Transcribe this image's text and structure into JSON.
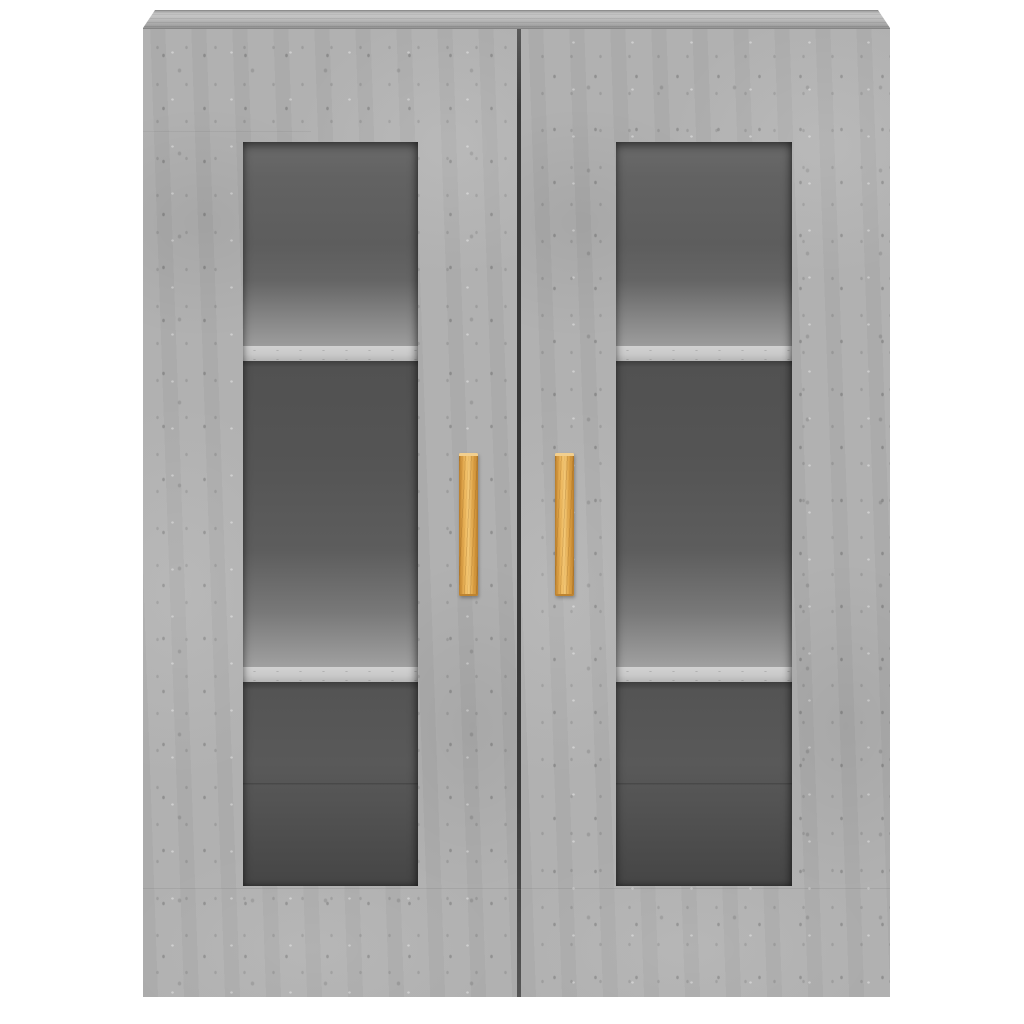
{
  "image": {
    "type": "product-photo",
    "subject": "Wall-mounted display cabinet with two glass doors in concrete grey finish",
    "background": "#ffffff"
  },
  "cabinet": {
    "finish": "concrete grey",
    "structure": {
      "doors": 2,
      "glass_panels_per_door": 1,
      "interior_sections_per_door": 3,
      "shelves_visible_per_door": 2,
      "handles": 2
    },
    "handle_material": "wood"
  },
  "colors": {
    "page_bg": "#ffffff",
    "concrete_base": "#afafaf",
    "concrete_light": "#c2c2c2",
    "concrete_dark": "#969696",
    "edge_line": "#858585",
    "door_seam": "#3c3c3c",
    "interior_top": "#616161",
    "interior_mid": "#555555",
    "interior_bottom": "#474747",
    "shelf_edge": "#c9c9c9",
    "handle_light": "#f3c877",
    "handle_mid": "#e2a94e",
    "handle_dark": "#b67c2c"
  }
}
